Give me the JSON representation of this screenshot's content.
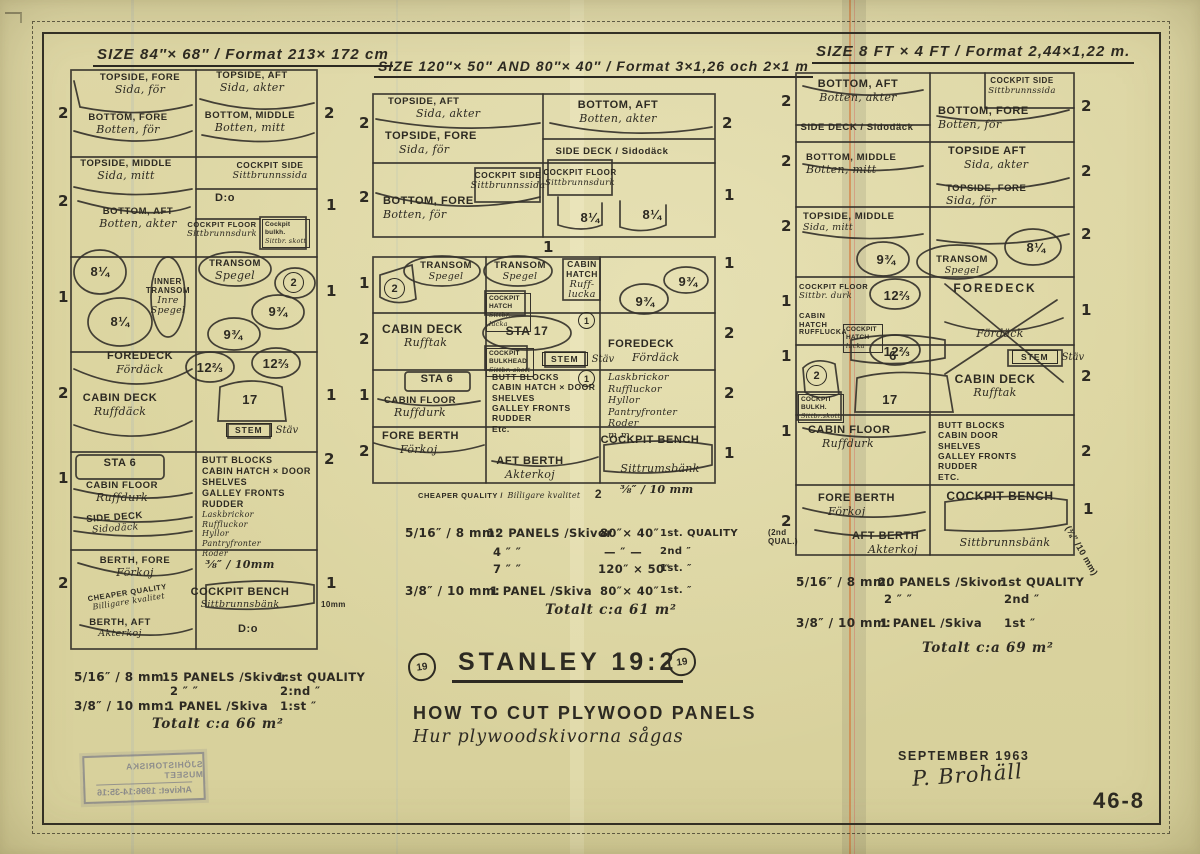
{
  "sheet": {
    "number": "46-8",
    "date": "SEPTEMBER 1963",
    "signature": "P. Brohäll",
    "logo": "19",
    "title": "STANLEY 19:2",
    "subtitle_en": "HOW TO CUT PLYWOOD PANELS",
    "subtitle_sv": "Hur plywoodskivorna sågas",
    "stamp_line1": "SJÖHISTORISKA MUSEET",
    "stamp_line2": "Arkivet: 1996:14-35:16",
    "ink_color": "#2d2a22",
    "paper_color": "#dcd5a2"
  },
  "d1": {
    "title": "SIZE 84″× 68″ / Format 213× 172 cm",
    "ml": [
      "2",
      "2",
      "1",
      "2",
      "1",
      "2"
    ],
    "mr": [
      "2",
      "1",
      "1",
      "1",
      "2",
      "1"
    ],
    "mr_note": "10mm",
    "topside_fore": {
      "en": "TOPSIDE, FORE",
      "sv": "Sida, för"
    },
    "topside_aft": {
      "en": "TOPSIDE, AFT",
      "sv": "Sida, akter"
    },
    "bottom_fore": {
      "en": "BOTTOM, FORE",
      "sv": "Botten, för"
    },
    "bottom_middle": {
      "en": "BOTTOM, MIDDLE",
      "sv": "Botten, mitt"
    },
    "topside_middle": {
      "en": "TOPSIDE, MIDDLE",
      "sv": "Sida, mitt"
    },
    "cockpit_side": {
      "en": "COCKPIT SIDE",
      "sv": "Sittbrunnssida"
    },
    "dito1": "D:o",
    "bottom_aft": {
      "en": "BOTTOM, AFT",
      "sv": "Botten, akter"
    },
    "cockpit_floor": {
      "en": "COCKPIT FLOOR",
      "sv": "Sittbrunnsdurk"
    },
    "bulkh": [
      "Cockpit",
      "bulkh.",
      "Sittbr.",
      "skott"
    ],
    "n814a": "8¼",
    "n814b": "8¼",
    "inner_transom": {
      "en1": "INNER",
      "en2": "TRANSOM",
      "sv1": "Inre",
      "sv2": "Spegel"
    },
    "transom": {
      "en": "TRANSOM",
      "sv": "Spegel"
    },
    "c2": "2",
    "n934a": "9¾",
    "n934b": "9¾",
    "foredeck": {
      "en": "FOREDECK",
      "sv": "Fördäck"
    },
    "n1223a": "12⅔",
    "n1223b": "12⅔",
    "n17": "17",
    "cabin_deck": {
      "en": "CABIN DECK",
      "sv": "Ruffdäck"
    },
    "stem": {
      "en": "STEM",
      "sv": "Stäv"
    },
    "sta6": "STA 6",
    "cabin_floor": {
      "en": "CABIN FLOOR",
      "sv": "Ruffdurk"
    },
    "side_deck": {
      "en": "SIDE DECK",
      "sv": "Sidodäck"
    },
    "butt_en": [
      "BUTT BLOCKS",
      "CABIN HATCH × DOOR",
      "SHELVES",
      "GALLEY FRONTS",
      "RUDDER"
    ],
    "butt_sv": [
      "Laskbrickor",
      "Ruffluckor",
      "Hyllor",
      "Pantryfronter",
      "Roder"
    ],
    "berth_fore": {
      "en": "BERTH, FORE",
      "sv": "Förkoj"
    },
    "cheaper": {
      "en": "CHEAPER QUALITY",
      "sv": "Billigare kvalitet"
    },
    "berth_aft": {
      "en": "BERTH, AFT",
      "sv": "Akterkoj"
    },
    "thickness": "⅜″ / 10mm",
    "cockpit_bench": {
      "en": "COCKPIT BENCH",
      "sv": "Sittbrunnsbänk"
    },
    "dito2": "D:o",
    "sum": {
      "r1a": "5/16″ / 8 mm:",
      "r1b": "15 PANELS /Skivor",
      "r1c": "1:st QUALITY",
      "r2b": "2    ″       ″",
      "r2c": "2:nd    ″",
      "r3a": "3/8″ / 10 mm:",
      "r3b": "1 PANEL /Skiva",
      "r3c": "1:st    ″",
      "total": "Totalt c:a 66 m²"
    }
  },
  "d2": {
    "title": "SIZE 120″× 50″ AND 80″× 40″ / Format 3×1,26 och 2×1 m",
    "mlA": [
      "2",
      "2"
    ],
    "mrA": [
      "2",
      "1"
    ],
    "mlB": [
      "1",
      "2",
      "1",
      "2"
    ],
    "mrB": [
      "1",
      "2",
      "2",
      "1"
    ],
    "top_count": "1",
    "topside_aft": {
      "en": "TOPSIDE, AFT",
      "sv": "Sida, akter"
    },
    "topside_fore": {
      "en": "TOPSIDE, FORE",
      "sv": "Sida, för"
    },
    "bottom_aft": {
      "en": "BOTTOM, AFT",
      "sv": "Botten, akter"
    },
    "side_deck": "SIDE DECK / Sidodäck",
    "bottom_fore": {
      "en": "BOTTOM, FORE",
      "sv": "Botten, för"
    },
    "cockpit_side": {
      "en": "COCKPIT SIDE",
      "sv": "Sittbrunnssida"
    },
    "cockpit_floor": {
      "en": "COCKPIT FLOOR",
      "sv": "Sittbrunnsdurk"
    },
    "n814a": "8¼",
    "n814b": "8¼",
    "c2": "2",
    "transom1": {
      "en": "TRANSOM",
      "sv": "Spegel"
    },
    "transom2": {
      "en": "TRANSOM",
      "sv": "Spegel"
    },
    "cockpit_hatch": [
      "COCKPIT",
      "HATCH",
      "Sittbr. lucka"
    ],
    "cabin_hatch": {
      "en1": "CABIN",
      "en2": "HATCH",
      "sv1": "Ruff-",
      "sv2": "lucka"
    },
    "n934a": "9¾",
    "n934b": "9¾",
    "cabin_deck": {
      "en": "CABIN DECK",
      "sv": "Rufftak"
    },
    "sta17": "STA 17",
    "c1a": "1",
    "cockpit_bulkhead": [
      "COCKPIT",
      "BULKHEAD",
      "Sittbr. skott"
    ],
    "stem": {
      "en": "STEM",
      "sv": "Stäv"
    },
    "foredeck": {
      "en": "FOREDECK",
      "sv": "Fördäck"
    },
    "sta6": "STA 6",
    "cabin_floor": {
      "en": "CABIN FLOOR",
      "sv": "Ruffdurk"
    },
    "butt_en": [
      "BUTT BLOCKS",
      "CABIN HATCH × DOOR",
      "SHELVES",
      "GALLEY FRONTS",
      "RUDDER",
      "Etc."
    ],
    "c1b": "1",
    "butt_sv": [
      "Laskbrickor",
      "Ruffluckor",
      "Hyllor",
      "Pantryfronter",
      "Roder",
      "m.m."
    ],
    "fore_berth": {
      "en": "FORE BERTH",
      "sv": "Förkoj"
    },
    "aft_berth": {
      "en": "AFT BERTH",
      "sv": "Akterkoj"
    },
    "cockpit_bench": {
      "en": "COCKPIT BENCH",
      "sv": "Sittrumsbänk"
    },
    "cheaper": {
      "en": "CHEAPER QUALITY /",
      "sv": "Billigare kvalitet",
      "count": "2"
    },
    "thickness": "⅜″ / 10 mm",
    "sum": {
      "r1a": "5/16″ / 8 mm:",
      "r1b": "12 PANELS /Skivor",
      "r1c": "80″× 40″",
      "r1d": "1st. QUALITY",
      "r2b": "4     ″        ″",
      "r2c": "— ″ —",
      "r2d": "2nd     ″",
      "r3b": "7     ″        ″",
      "r3c": "120″ × 50″",
      "r3d": "1st.     ″",
      "r4a": "3/8″ / 10 mm:",
      "r4b": "1 PANEL /Skiva",
      "r4c": "80″× 40″",
      "r4d": "1st.     ″",
      "total": "Totalt c:a 61 m²"
    }
  },
  "d3": {
    "title": "SIZE 8 FT × 4 FT / Format 2,44×1,22 m.",
    "ml": [
      "2",
      "2",
      "2",
      "1",
      "1",
      "1",
      "2"
    ],
    "ml_note1": "(2nd",
    "ml_note2": "QUAL.)",
    "mr": [
      "2",
      "2",
      "2",
      "1",
      "2",
      "2",
      "1"
    ],
    "mr_note": "(⅜″ /10 mm)",
    "bottom_aft": {
      "en": "BOTTOM, AFT",
      "sv": "Botten, akter"
    },
    "side_deck": "SIDE DECK / Sidodäck",
    "cockpit_side": {
      "en": "COCKPIT SIDE",
      "sv": "Sittbrunnssida"
    },
    "bottom_fore": {
      "en": "BOTTOM, FORE",
      "sv": "Botten, för"
    },
    "bottom_middle": {
      "en": "BOTTOM, MIDDLE",
      "sv": "Botten, mitt"
    },
    "topside_aft": {
      "en": "TOPSIDE AFT",
      "sv": "Sida, akter"
    },
    "topside_fore": {
      "en": "TOPSIDE, FORE",
      "sv": "Sida, för"
    },
    "topside_middle": {
      "en": "TOPSIDE, MIDDLE",
      "sv": "Sida, mitt"
    },
    "n934": "9¾",
    "transom": {
      "en": "TRANSOM",
      "sv": "Spegel"
    },
    "n814": "8¼",
    "cockpit_floor": {
      "en": "COCKPIT FLOOR",
      "sv": "Sittbr. durk"
    },
    "n1223a": "12⅔",
    "n1223b": "12⅔",
    "cabin_hatch": {
      "en1": "CABIN",
      "en2": "HATCH",
      "sv": "RUFFLUCKA"
    },
    "cockpit_hatch": [
      "COCKPIT",
      "HATCH",
      "lucka"
    ],
    "foredeck": {
      "en": "FOREDECK",
      "sv": "Fördäck"
    },
    "c2": "2",
    "n6": "6",
    "n17": "17",
    "cockpit_bulkh": [
      "COCKPIT",
      "BULKH.",
      "Sittbr.skott"
    ],
    "stem": {
      "en": "STEM",
      "sv": "Stäv"
    },
    "cabin_deck": {
      "en": "CABIN DECK",
      "sv": "Rufftak"
    },
    "cabin_floor": {
      "en": "CABIN FLOOR",
      "sv": "Ruffdurk"
    },
    "butt_en": [
      "BUTT BLOCKS",
      "CABIN DOOR",
      "SHELVES",
      "GALLEY FRONTS",
      "RUDDER",
      "ETC."
    ],
    "fore_berth": {
      "en": "FORE BERTH",
      "sv": "Förkoj"
    },
    "aft_berth": {
      "en": "AFT BERTH",
      "sv": "Akterkoj"
    },
    "cockpit_bench": {
      "en": "COCKPIT BENCH",
      "sv": "Sittbrunnsbänk"
    },
    "sum": {
      "r1a": "5/16″ / 8 mm:",
      "r1b": "20 PANELS /Skivor",
      "r1c": "1st QUALITY",
      "r2b": "2      ″         ″",
      "r2c": "2nd     ″",
      "r3a": "3/8″ / 10 mm:",
      "r3b": "1 PANEL /Skiva",
      "r3c": "1st     ″",
      "total": "Totalt c:a 69 m²"
    }
  }
}
